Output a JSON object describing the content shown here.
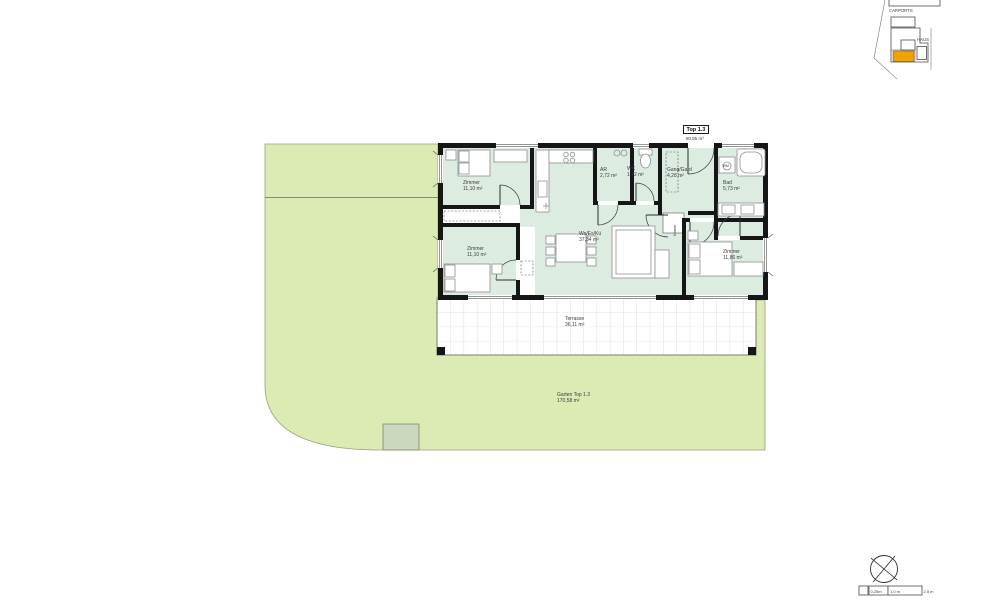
{
  "plan": {
    "unit_box": {
      "label": "Top 1.3",
      "area": "80,85 m²"
    },
    "rooms": {
      "zimmer_tl": {
        "name": "Zimmer",
        "area": "11,10 m²"
      },
      "zimmer_bl": {
        "name": "Zimmer",
        "area": "11,10 m²"
      },
      "wohn_ess_kueche": {
        "name": "Wo/Es/Kü",
        "area": "37,34 m²"
      },
      "abstellraum": {
        "name": "AR",
        "area": "2,72 m²"
      },
      "wc": {
        "name": "WC",
        "area": "1,72 m²"
      },
      "gang_garderobe": {
        "name": "Gang/Gard",
        "area": "4,28 m²"
      },
      "bad": {
        "name": "Bad",
        "area": "5,73 m²"
      },
      "zimmer_rechts": {
        "name": "Zimmer",
        "area": "11,86 m²"
      },
      "kamin": {
        "name": "Kamin"
      }
    },
    "outdoor": {
      "terrasse": {
        "name": "Terrasse",
        "area": "36,11 m²"
      },
      "garten": {
        "name": "Garten Top 1.3",
        "area": "170,58 m²"
      }
    },
    "appliance_labels": {
      "waschmaschine": "WM"
    }
  },
  "site_overview": {
    "carports_label": "CARPORTS",
    "haus_label": "HAUS"
  },
  "scale_bar": {
    "segment_small": "0,25m",
    "segment_mid": "1,0 m",
    "segment_large": "2,5 m"
  },
  "colors": {
    "garden_green": "#dcebb4",
    "room_mint": "#dcece1",
    "highlight_orange": "#f0a200",
    "wall_black": "#161616"
  }
}
